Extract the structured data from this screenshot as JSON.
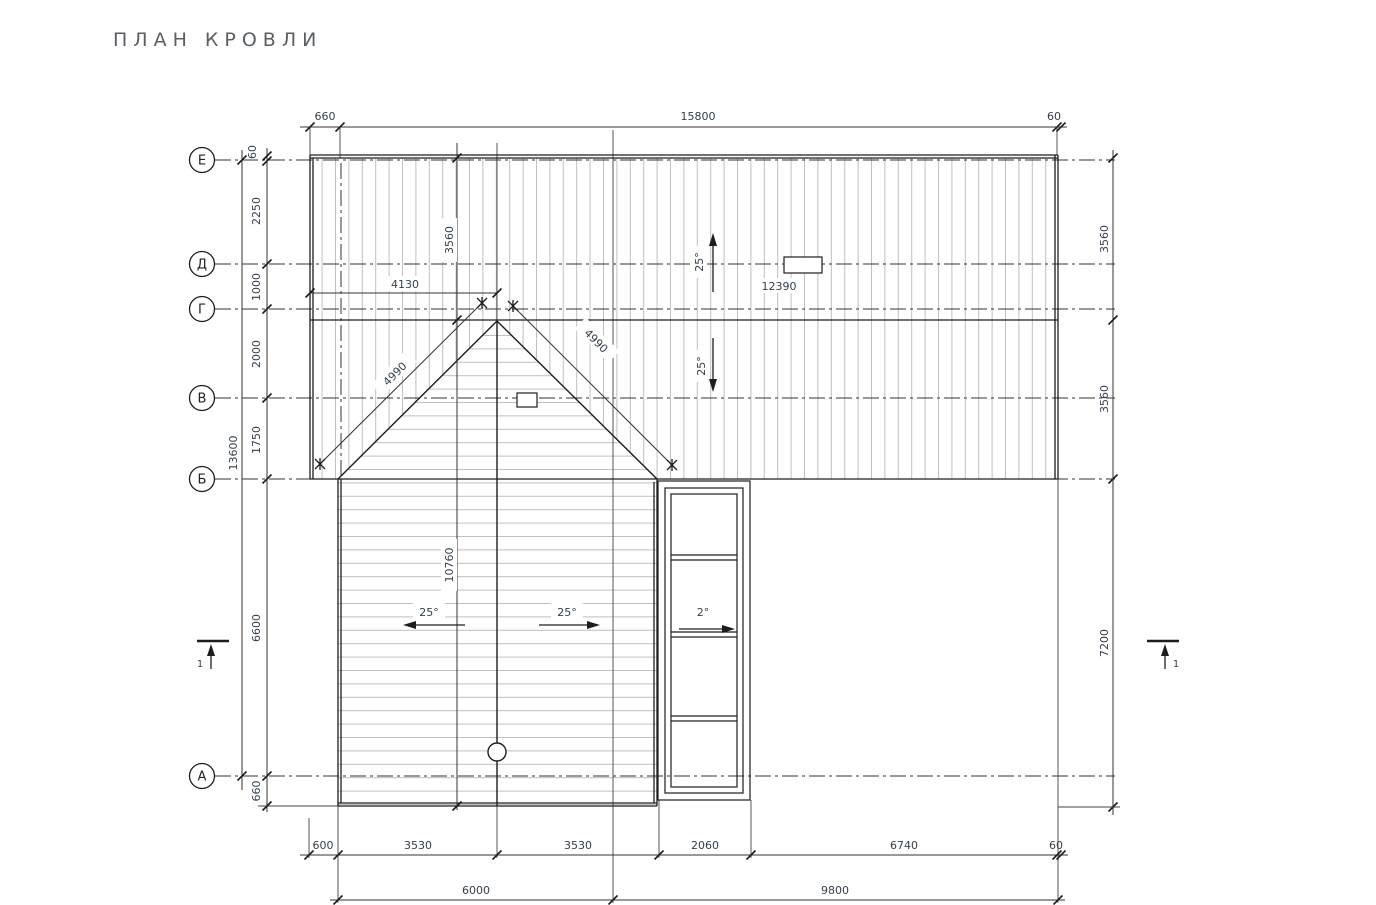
{
  "title": "ПЛАН КРОВЛИ",
  "axes": [
    "Е",
    "Д",
    "Г",
    "В",
    "Б",
    "А"
  ],
  "dims": {
    "top": {
      "offset_left": "660",
      "main": "15800",
      "offset_right": "60"
    },
    "left": {
      "eave": "60",
      "e_d": "2250",
      "d_g": "1000",
      "g_v": "2000",
      "v_b": "1750",
      "b_a": "6600",
      "a_eave": "660",
      "total": "13600"
    },
    "right": {
      "upper": "3560",
      "lower": "3560",
      "south": "7200"
    },
    "inner": {
      "north_slope": "3560",
      "ridge": "10760",
      "gable_width": "4130",
      "rafter_left": "4990",
      "rafter_right": "4990",
      "main_ridge": "12390"
    },
    "bottom": {
      "eave": "600",
      "left_slope": "3530",
      "right_slope": "3530",
      "bay": "2060",
      "right_part": "6740",
      "offset_right": "60",
      "total_left": "6000",
      "total_right": "9800"
    }
  },
  "slopes": {
    "main_up": "25°",
    "main_down": "25°",
    "lower_left": "25°",
    "lower_right": "25°",
    "bay": "2°"
  },
  "sections": {
    "left": "1",
    "right": "1"
  },
  "colors": {
    "line": "#222222",
    "hatch": "#bfbfbf",
    "dim_text": "#333f4c",
    "title_text": "#5a5f64"
  }
}
